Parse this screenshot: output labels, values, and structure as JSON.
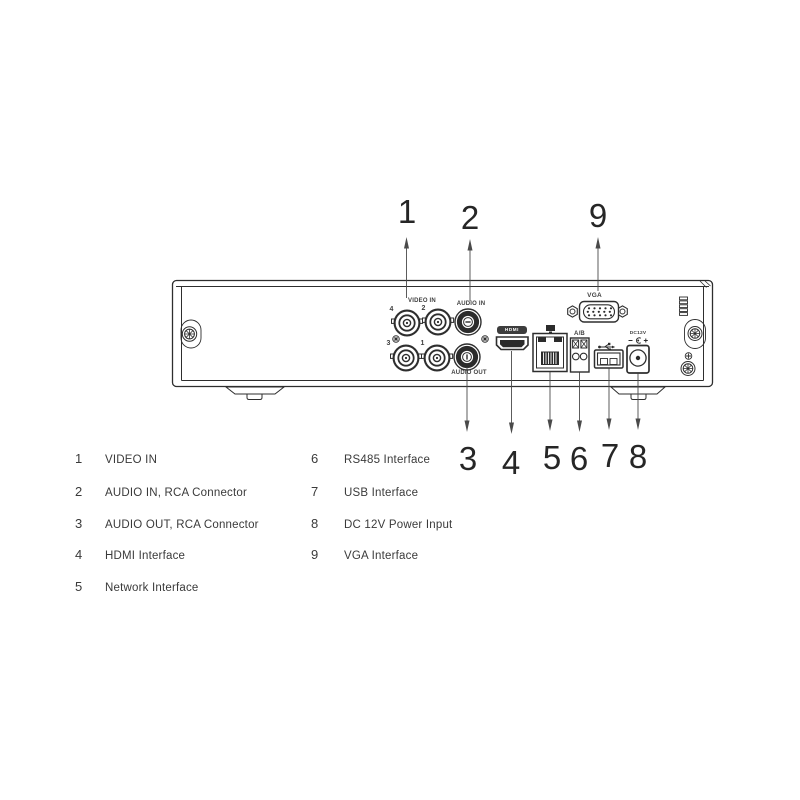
{
  "callouts": {
    "n1": "1",
    "n2": "2",
    "n3": "3",
    "n4": "4",
    "n5": "5",
    "n6": "6",
    "n7": "7",
    "n8": "8",
    "n9": "9"
  },
  "panel": {
    "video_in": "VIDEO IN",
    "audio_in": "AUDIO IN",
    "audio_out": "AUDIO OUT",
    "hdmi": "HDMI",
    "rs485_ab": "A/B",
    "vga": "VGA",
    "dc12v": "DC12V",
    "bnc_4": "4",
    "bnc_2": "2",
    "bnc_3": "3",
    "bnc_1": "1"
  },
  "legend": {
    "left": [
      {
        "num": "1",
        "label": "VIDEO IN"
      },
      {
        "num": "2",
        "label": "AUDIO IN, RCA Connector"
      },
      {
        "num": "3",
        "label": "AUDIO OUT, RCA Connector"
      },
      {
        "num": "4",
        "label": "HDMI Interface"
      },
      {
        "num": "5",
        "label": "Network Interface"
      }
    ],
    "right": [
      {
        "num": "6",
        "label": "RS485 Interface"
      },
      {
        "num": "7",
        "label": "USB Interface"
      },
      {
        "num": "8",
        "label": "DC 12V Power Input"
      },
      {
        "num": "9",
        "label": "VGA Interface"
      }
    ]
  },
  "icons": {
    "usb-icon": "usb-trident",
    "network-icon": "lan-port",
    "dc-polarity-icon": "center-positive",
    "screw-icon": "phillips-screw",
    "ground-icon": "cross-circle",
    "vent-grille": "slot-vent"
  },
  "colors": {
    "background": "#ffffff",
    "line": "#2e2e2e",
    "dark_fill": "#2b2b2b",
    "text": "#3a3a3a",
    "leader": "#4a4a4a"
  }
}
